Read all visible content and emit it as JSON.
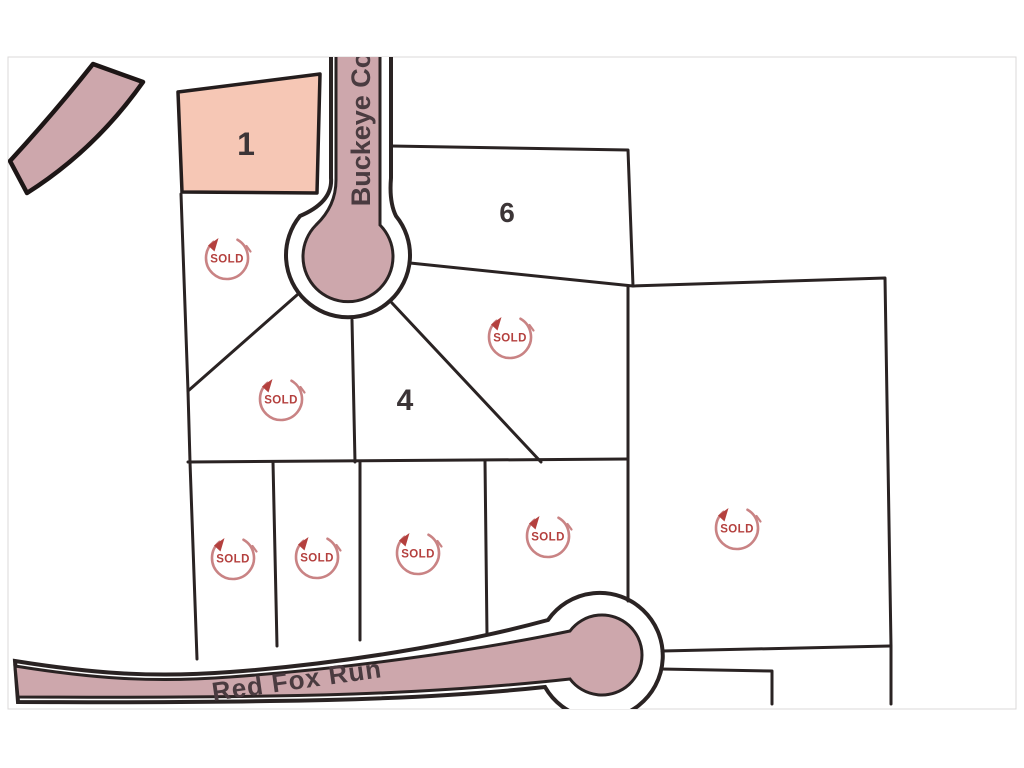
{
  "map": {
    "roads": {
      "buckeye": {
        "label": "Buckeye Co"
      },
      "red_fox": {
        "label": "Red Fox Run"
      }
    },
    "lots": [
      {
        "number": "1",
        "highlighted": true
      },
      {
        "number": "6",
        "highlighted": false
      },
      {
        "number": "4",
        "highlighted": false
      }
    ],
    "sold_label": "SOLD",
    "sold_stamps": [
      {
        "x": 227,
        "y": 258
      },
      {
        "x": 281,
        "y": 399
      },
      {
        "x": 510,
        "y": 337
      },
      {
        "x": 233,
        "y": 558
      },
      {
        "x": 317,
        "y": 557
      },
      {
        "x": 418,
        "y": 553
      },
      {
        "x": 548,
        "y": 536
      },
      {
        "x": 737,
        "y": 528
      }
    ],
    "colors": {
      "road_fill": "#cda7ac",
      "lot1_fill": "#f6c7b5",
      "line_dark": "#2a2323",
      "label_dark": "#4a3b40",
      "stamp_red": "#b4403e",
      "stamp_faded": "#c98384"
    }
  }
}
